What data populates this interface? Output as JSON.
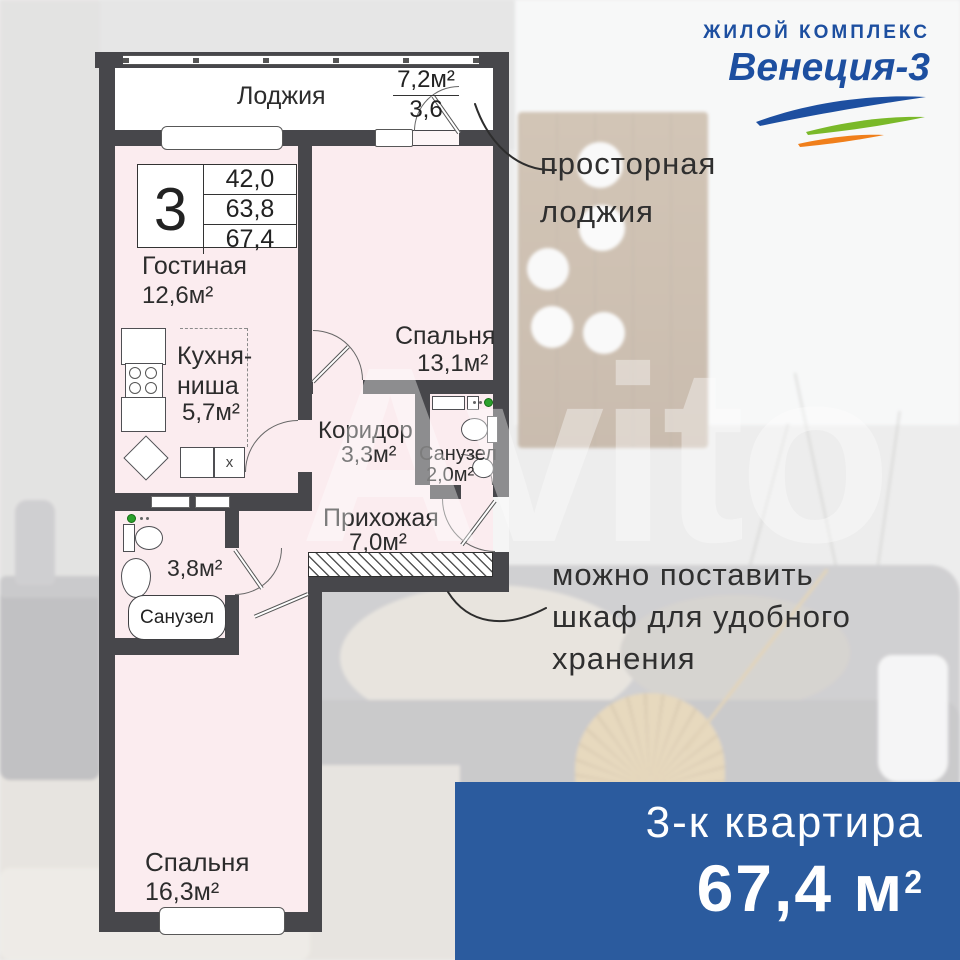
{
  "logo": {
    "subtitle": "ЖИЛОЙ КОМПЛЕКС",
    "title": "Венеция-3"
  },
  "watermark": "Avito",
  "plan": {
    "loggia": {
      "name": "Лоджия",
      "area": "7,2м²",
      "area_reduced": "3,6"
    },
    "badge": {
      "rooms_count": "3",
      "area_living": "42,0",
      "area_main": "63,8",
      "area_total": "67,4"
    },
    "rooms": {
      "living": {
        "name": "Гостиная",
        "area": "12,6м²"
      },
      "kitchen": {
        "name_line1": "Кухня-",
        "name_line2": "ниша",
        "area": "5,7м²"
      },
      "bedroom_top": {
        "name": "Спальня",
        "area": "13,1м²"
      },
      "corridor": {
        "name": "Коридор",
        "area": "3,3м²"
      },
      "bathroom_small": {
        "name": "Санузел",
        "area": "2,0м²"
      },
      "hallway": {
        "name": "Прихожая",
        "area": "7,0м²"
      },
      "bathroom_main": {
        "name": "Санузел",
        "area": "3,8м²"
      },
      "bedroom_bottom": {
        "name": "Спальня",
        "area": "16,3м²"
      }
    },
    "marks": {
      "kitchen_box": "х"
    }
  },
  "annotations": {
    "loggia_note": {
      "line1": "просторная",
      "line2": "лоджия"
    },
    "wardrobe_note": {
      "line1": "можно поставить",
      "line2": "шкаф для удобного",
      "line3": "хранения"
    }
  },
  "banner": {
    "type_label": "3-к квартира",
    "area_value": "67,4 м",
    "area_sup": "2"
  },
  "colors": {
    "banner_blue": "#2b5b9e",
    "logo_blue": "#1d4fa0",
    "wall_dark": "#47474b",
    "room_pink": "#fbecef",
    "swoosh_green": "#7ab929",
    "swoosh_orange": "#f07f1b"
  }
}
